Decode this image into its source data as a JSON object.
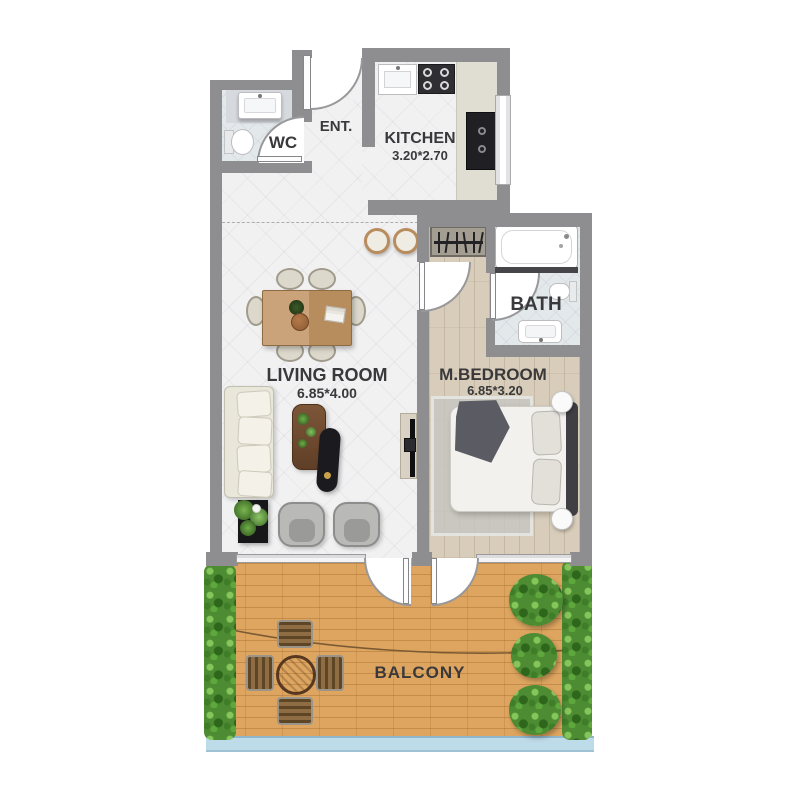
{
  "rooms": {
    "wc": {
      "label": "WC"
    },
    "entrance": {
      "label": "ENT."
    },
    "kitchen": {
      "label": "KITCHEN",
      "dimensions": "3.20*2.70"
    },
    "living_room": {
      "label": "LIVING ROOM",
      "dimensions": "6.85*4.00"
    },
    "bath": {
      "label": "BATH"
    },
    "master_bedroom": {
      "label": "M.BEDROOM",
      "dimensions": "6.85*3.20"
    },
    "balcony": {
      "label": "BALCONY"
    }
  },
  "furniture": {
    "wc": [
      "sink",
      "toilet",
      "door"
    ],
    "entrance": [
      "entry-door"
    ],
    "kitchen": [
      "sink-unit",
      "stove-4-burners",
      "counter",
      "tall-black-unit",
      "window",
      "bar-stools"
    ],
    "living_room": [
      "dining-table-6-chairs",
      "sofa",
      "coffee-table",
      "ottoman",
      "potted-plant",
      "two-armchairs",
      "tv-console"
    ],
    "bath": [
      "bathtub",
      "toilet",
      "vanity-sink",
      "door"
    ],
    "master_bedroom": [
      "wardrobe-hangers",
      "double-bed",
      "rug",
      "two-round-nightstands",
      "door"
    ],
    "balcony": [
      "round-table",
      "four-slat-chairs",
      "three-bushes",
      "side-hedges",
      "glass-railing",
      "two-doors"
    ]
  },
  "colors": {
    "wall": "#8e8e90",
    "floor": "#f1f1f2",
    "wet": "#e3e8eb",
    "wood": "#d8cdba",
    "deck": "#dda55f",
    "hedge": "#4e8c33",
    "railing": "#bedbe9"
  }
}
